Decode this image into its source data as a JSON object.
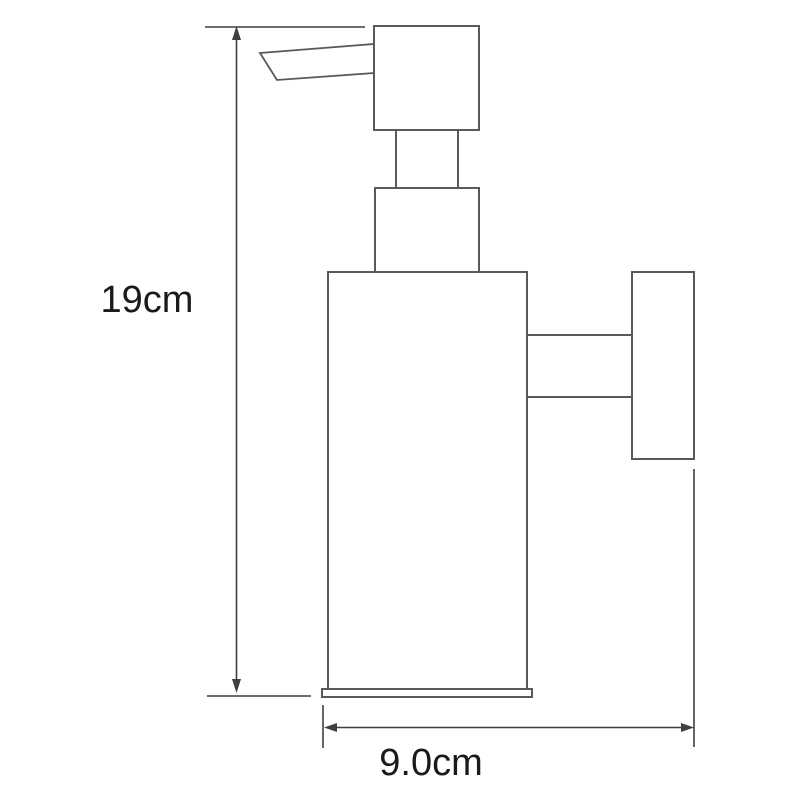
{
  "page": {
    "background": "#ffffff"
  },
  "diagram": {
    "kind": "product-dimension-drawing",
    "subject": "wall-mounted-soap-dispenser",
    "stroke_color": "#58595b",
    "dimension_line_color": "#3f3f3f",
    "text_color": "#1a1a1a",
    "dimensions": {
      "height_label": "19cm",
      "width_label": "9.0cm"
    },
    "parts": [
      "spout",
      "pump-head",
      "neck",
      "collar",
      "body",
      "base-plate",
      "mount-arm",
      "wall-plate"
    ]
  }
}
